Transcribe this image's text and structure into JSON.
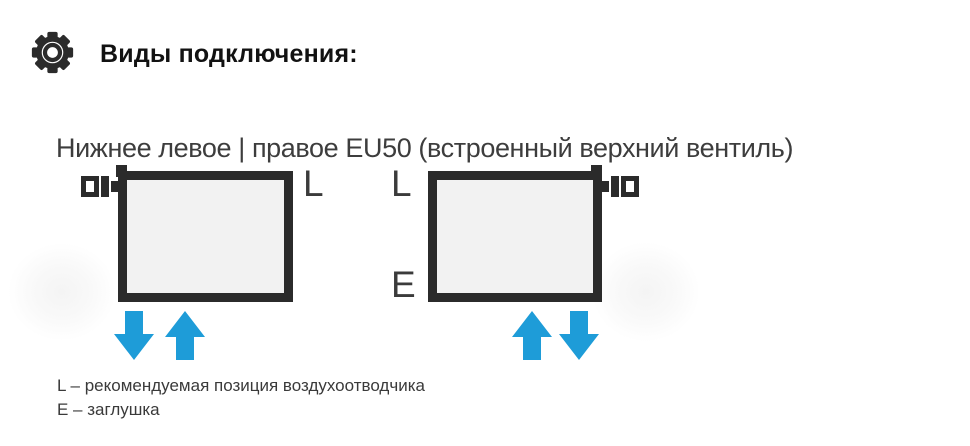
{
  "header": {
    "icon": "gear",
    "title": "Виды подключения:"
  },
  "connection": {
    "subtitle": "Нижнее левое | правое EU50 (встроенный верхний вентиль)",
    "radiator_left": {
      "valve_side": "top-left",
      "label_top_right": "L",
      "arrows": [
        "down",
        "up"
      ]
    },
    "radiator_right": {
      "valve_side": "top-right",
      "label_top_left": "L",
      "label_bottom_left": "E",
      "arrows": [
        "up",
        "down"
      ]
    },
    "legend": [
      "L – рекомендуемая позиция воздухоотводчика",
      "E – заглушка"
    ]
  },
  "colors": {
    "arrow_blue": "#1e9cd8",
    "shape_dark": "#2b2b2b",
    "radiator_fill": "#f2f2f2"
  }
}
